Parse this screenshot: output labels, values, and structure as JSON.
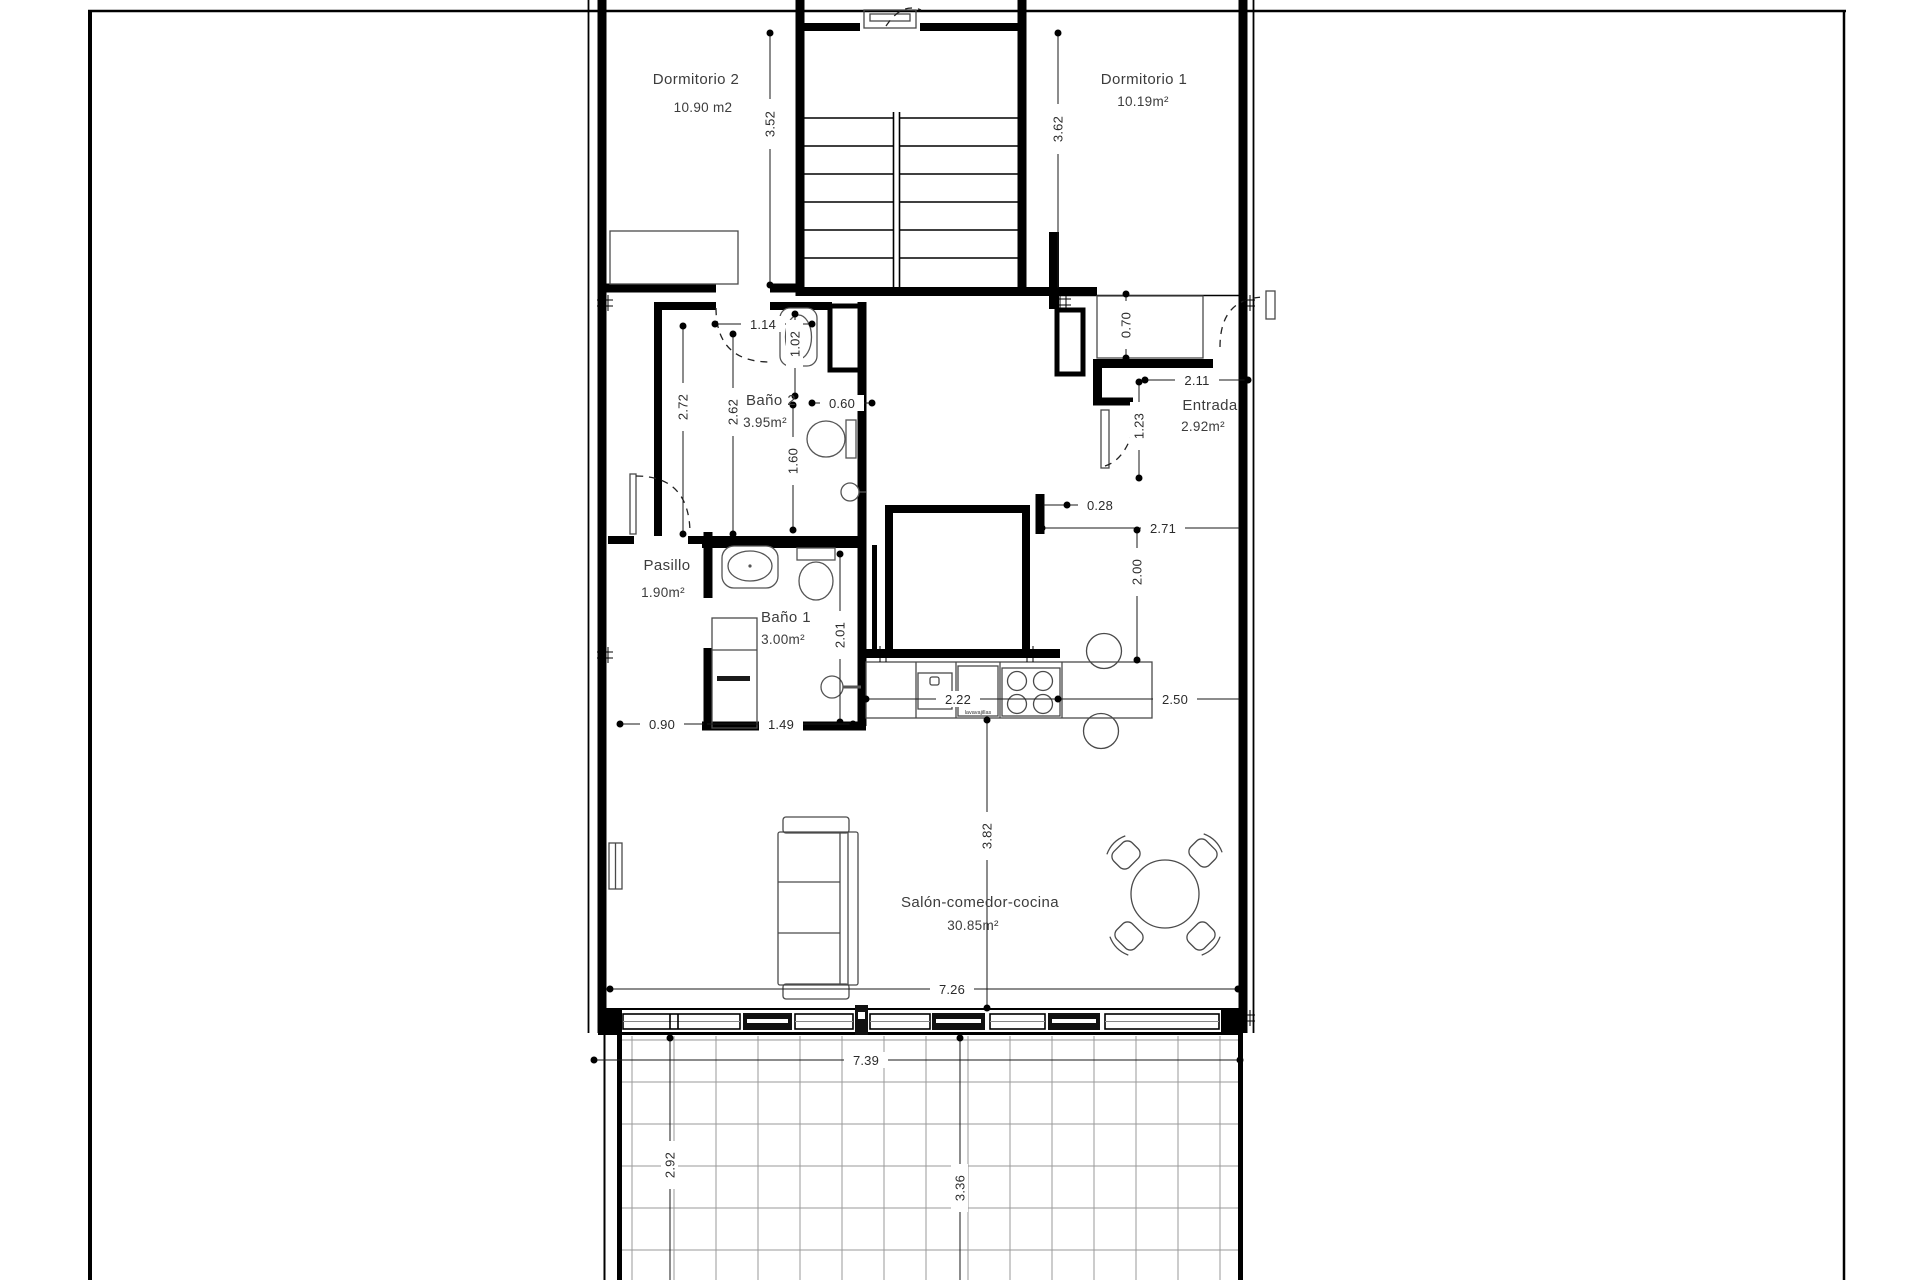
{
  "plan": {
    "rooms": {
      "dormitorio2": {
        "name": "Dormitorio 2",
        "area": "10.90 m2"
      },
      "dormitorio1": {
        "name": "Dormitorio 1",
        "area": "10.19m²"
      },
      "bano2": {
        "name": "Baño 2",
        "area": "3.95m²"
      },
      "entrada": {
        "name": "Entrada",
        "area": "2.92m²"
      },
      "pasillo": {
        "name": "Pasillo",
        "area": "1.90m²"
      },
      "bano1": {
        "name": "Baño 1",
        "area": "3.00m²"
      },
      "salon": {
        "name": "Salón-comedor-cocina",
        "area": "30.85m²"
      }
    },
    "dims": {
      "d352": "3.52",
      "d362": "3.62",
      "d114": "1.14",
      "d102": "1.02",
      "d272": "2.72",
      "d262": "2.62",
      "d060": "0.60",
      "d160": "1.60",
      "d070": "0.70",
      "d211": "2.11",
      "d123": "1.23",
      "d028": "0.28",
      "d271": "2.71",
      "d200": "2.00",
      "d201": "2.01",
      "d090": "0.90",
      "d149": "1.49",
      "d222": "2.22",
      "d250": "2.50",
      "d382": "3.82",
      "d726": "7.26",
      "d739": "7.39",
      "d292": "2.92",
      "d336": "3.36"
    },
    "labels": {
      "dishwasher": "lavavajillas"
    },
    "colors": {
      "ink": "#000000",
      "text": "#3c3c3c",
      "grid": "#9a9a9a"
    }
  }
}
